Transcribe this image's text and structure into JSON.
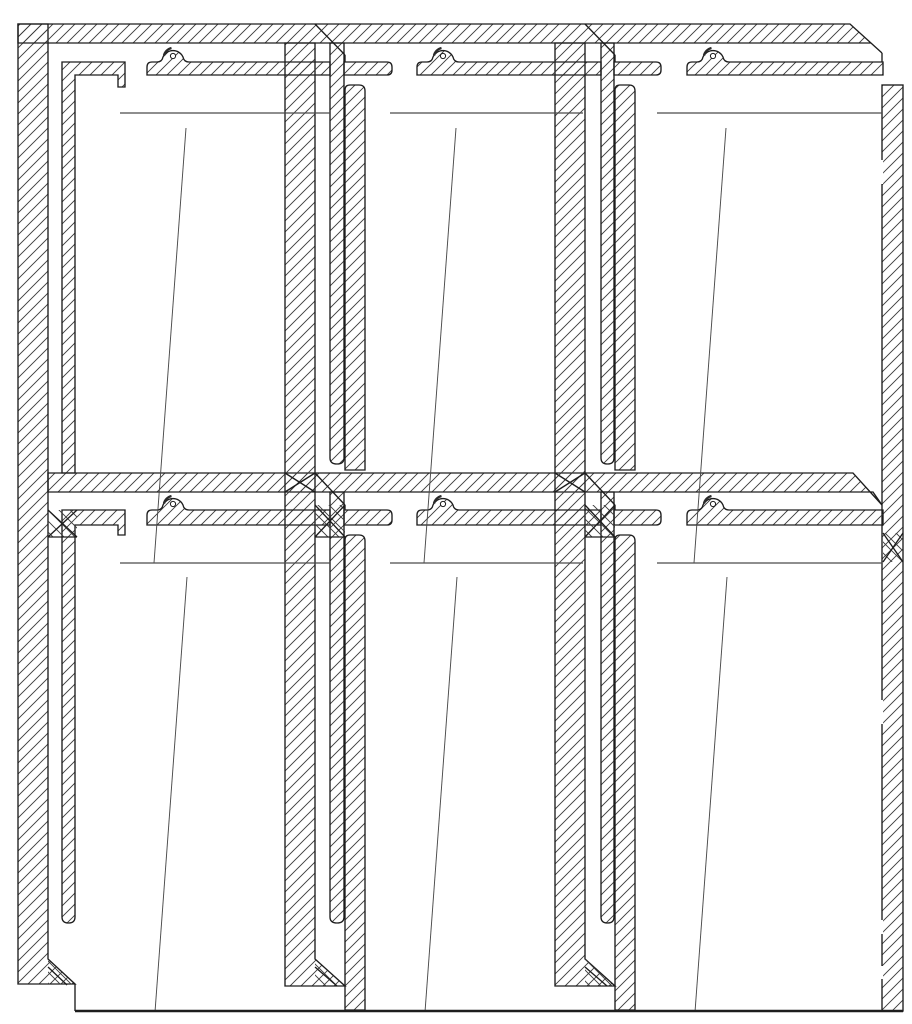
{
  "canvas": {
    "width": 912,
    "height": 1024,
    "background": "#ffffff"
  },
  "style": {
    "stroke": "#1d1d1d",
    "stroke_width": 1.35,
    "hatch_color": "#3c3c3c",
    "hatch_spacing": 11,
    "glass_line_color": "#4a4a4a",
    "boss_shadow_color": "#2a2a2a",
    "base_line_width": 2.4,
    "background": "#ffffff"
  },
  "drawing": {
    "kind": "cad-section-detail",
    "description": "Sectional detail of a six-panel glazed frame wall: 2 rows x 3 columns, hatched cut profiles, screw bosses, mitered joints",
    "rows": 2,
    "columns": 3,
    "screw_boss_count": 6
  },
  "shapes": [
    {
      "name": "left-jamb-profile",
      "t": "path",
      "d": "M18 24 H48 V959 L75 984 H18 Z"
    },
    {
      "name": "head-bar",
      "t": "path",
      "d": "M18 24 H850 L882 53 L871 43 H18 Z"
    },
    {
      "name": "mid-transom-bar",
      "t": "path",
      "d": "M48 473 H853 L882 505 L873 492 H48 Z"
    },
    {
      "name": "mullion-1-main-bar",
      "t": "path",
      "d": "M285 43 H315 V959 L345 986 H285 Z"
    },
    {
      "name": "mullion-2-main-bar",
      "t": "path",
      "d": "M555 43 H585 V959 L615 986 H555 Z"
    },
    {
      "name": "right-jamb-bar",
      "t": "rect",
      "x": 882,
      "y": 85,
      "w": 21,
      "h": 926
    },
    {
      "name": "glazing-L-profile-top-left",
      "t": "path",
      "d": "M62 62 H125 V87 H118 V75 H75 V473 H62 Z"
    },
    {
      "name": "glazing-L-profile-bottom-left",
      "t": "path",
      "d": "M62 510 H125 V535 H118 V525 H75 V917 Q75 923 68.5 923 Q62 923 62 917 Z"
    },
    {
      "name": "mullion-1-inner-profile-top",
      "t": "path",
      "d": "M330 43 H344 V458 Q344 464 337 464 Q330 464 330 458 Z"
    },
    {
      "name": "mullion-1-inner-profile-bottom",
      "t": "path",
      "d": "M330 492 H344 V917 Q344 923 337 923 Q330 923 330 917 Z"
    },
    {
      "name": "mullion-2-inner-profile-top",
      "t": "path",
      "d": "M601 43 H614 V458 Q614 464 607.5 464 Q601 464 601 458 Z"
    },
    {
      "name": "mullion-2-inner-profile-bottom",
      "t": "path",
      "d": "M601 492 H614 V917 Q614 923 607.5 923 Q601 923 601 917 Z"
    },
    {
      "name": "mullion-1-stop-profile-top",
      "t": "path",
      "d": "M345 470 V90 Q345 85 350 85 H359 Q365 85 365 91 V470 Z"
    },
    {
      "name": "mullion-1-stop-profile-bottom",
      "t": "path",
      "d": "M345 1010 V540 Q345 535 350 535 H359 Q365 535 365 541 V1010 Z"
    },
    {
      "name": "mullion-2-stop-profile-top",
      "t": "path",
      "d": "M615 470 V90 Q615 85 620 85 H629 Q635 85 635 91 V470 Z"
    },
    {
      "name": "mullion-2-stop-profile-bottom",
      "t": "path",
      "d": "M615 1010 V540 Q615 535 620 535 H629 Q635 535 635 541 V1010 Z"
    },
    {
      "name": "boss-strip-top-1",
      "t": "path",
      "d": "M147 75 V67 Q147 62 152 62 H157 Q162 62 163 57 A11 11 0 0 1 183 57 Q184 62 189 62 H330 V75 Z"
    },
    {
      "name": "boss-strip-top-2",
      "t": "path",
      "d": "M417 75 V67 Q417 62 422 62 H427 Q432 62 433 57 A11 11 0 0 1 453 57 Q454 62 459 62 H601 V75 Z"
    },
    {
      "name": "boss-strip-top-3",
      "t": "path",
      "d": "M687 75 V67 Q687 62 692 62 H697 Q702 62 703 57 A11 11 0 0 1 723 57 Q724 62 729 62 H883 V75 Z"
    },
    {
      "name": "stop-strip-top-a",
      "t": "path",
      "d": "M344 62 H387 Q392 62 392 67 V70 Q392 75 387 75 H344 Z"
    },
    {
      "name": "stop-strip-top-b",
      "t": "path",
      "d": "M614 62 H656 Q661 62 661 67 V70 Q661 75 656 75 H614 Z"
    },
    {
      "name": "boss-strip-mid-1",
      "t": "path",
      "d": "M147 525 V515 Q147 510 152 510 H157 Q162 510 163 505 A11 11 0 0 1 183 505 Q184 510 189 510 H330 V525 Z"
    },
    {
      "name": "boss-strip-mid-2",
      "t": "path",
      "d": "M417 525 V515 Q417 510 422 510 H427 Q432 510 433 505 A11 11 0 0 1 453 505 Q454 510 459 510 H601 V525 Z"
    },
    {
      "name": "boss-strip-mid-3",
      "t": "path",
      "d": "M687 525 V515 Q687 510 692 510 H697 Q702 510 703 505 A11 11 0 0 1 723 505 Q724 510 729 510 H883 V525 Z"
    },
    {
      "name": "stop-strip-mid-a",
      "t": "path",
      "d": "M344 510 H387 Q392 510 392 515 V520 Q392 525 387 525 H344 Z"
    },
    {
      "name": "stop-strip-mid-b",
      "t": "path",
      "d": "M614 510 H656 Q661 510 661 515 V520 Q661 525 656 525 H614 Z"
    },
    {
      "name": "miter-zone-left-mid",
      "t": "rect",
      "x": 48,
      "y": 510,
      "w": 29,
      "h": 27,
      "f": "hatchX",
      "sw": 0
    },
    {
      "name": "miter-zone-mullion-1-mid",
      "t": "rect",
      "x": 315,
      "y": 505,
      "w": 30,
      "h": 32,
      "f": "hatchX",
      "sw": 0
    },
    {
      "name": "miter-zone-mullion-2-mid",
      "t": "rect",
      "x": 585,
      "y": 505,
      "w": 30,
      "h": 32,
      "f": "hatchX",
      "sw": 0
    },
    {
      "name": "miter-zone-right-mid",
      "t": "rect",
      "x": 883,
      "y": 533,
      "w": 20,
      "h": 29,
      "f": "hatchX",
      "sw": 0
    },
    {
      "name": "chamfer-fill-left-bottom",
      "t": "path",
      "d": "M48 959 L75 984 H48 Z",
      "f": "hatchX",
      "sw": 0
    },
    {
      "name": "chamfer-fill-mullion-1-bottom",
      "t": "path",
      "d": "M315 959 L345 986 H315 Z",
      "f": "hatchX",
      "sw": 0
    },
    {
      "name": "chamfer-fill-mullion-2-bottom",
      "t": "path",
      "d": "M585 959 L615 986 H585 Z",
      "f": "hatchX",
      "sw": 0
    },
    {
      "name": "screw-boss-circle",
      "t": "circle",
      "cx": 173,
      "cy": 56,
      "r": 2.6,
      "f": "white",
      "sw": 1
    },
    {
      "name": "screw-boss-circle",
      "t": "circle",
      "cx": 443,
      "cy": 56,
      "r": 2.6,
      "f": "white",
      "sw": 1
    },
    {
      "name": "screw-boss-circle",
      "t": "circle",
      "cx": 713,
      "cy": 56,
      "r": 2.6,
      "f": "white",
      "sw": 1
    },
    {
      "name": "screw-boss-circle",
      "t": "circle",
      "cx": 173,
      "cy": 504,
      "r": 2.6,
      "f": "white",
      "sw": 1
    },
    {
      "name": "screw-boss-circle",
      "t": "circle",
      "cx": 443,
      "cy": 504,
      "r": 2.6,
      "f": "white",
      "sw": 1
    },
    {
      "name": "screw-boss-circle",
      "t": "circle",
      "cx": 713,
      "cy": 504,
      "r": 2.6,
      "f": "white",
      "sw": 1
    },
    {
      "name": "boss-shadow-arc",
      "t": "path",
      "d": "M164 55.5 A10 10 0 0 1 171.5 48",
      "f": "none",
      "sw": 2.4,
      "sc": "shadow"
    },
    {
      "name": "boss-shadow-arc",
      "t": "path",
      "d": "M434 55.5 A10 10 0 0 1 441.5 48",
      "f": "none",
      "sw": 2.4,
      "sc": "shadow"
    },
    {
      "name": "boss-shadow-arc",
      "t": "path",
      "d": "M704 55.5 A10 10 0 0 1 711.5 48",
      "f": "none",
      "sw": 2.4,
      "sc": "shadow"
    },
    {
      "name": "boss-shadow-arc",
      "t": "path",
      "d": "M164 503.5 A10 10 0 0 1 171.5 496",
      "f": "none",
      "sw": 2.4,
      "sc": "shadow"
    },
    {
      "name": "boss-shadow-arc",
      "t": "path",
      "d": "M434 503.5 A10 10 0 0 1 441.5 496",
      "f": "none",
      "sw": 2.4,
      "sc": "shadow"
    },
    {
      "name": "boss-shadow-arc",
      "t": "path",
      "d": "M704 503.5 A10 10 0 0 1 711.5 496",
      "f": "none",
      "sw": 2.4,
      "sc": "shadow"
    },
    {
      "name": "head-seam-mullion-1",
      "t": "line",
      "x1": 315,
      "y1": 24,
      "x2": 345,
      "y2": 55
    },
    {
      "name": "head-seam-mullion-1-drop",
      "t": "line",
      "x1": 345,
      "y1": 55,
      "x2": 345,
      "y2": 62
    },
    {
      "name": "head-seam-mullion-2",
      "t": "line",
      "x1": 585,
      "y1": 24,
      "x2": 615,
      "y2": 55
    },
    {
      "name": "head-seam-mullion-2-drop",
      "t": "line",
      "x1": 615,
      "y1": 55,
      "x2": 615,
      "y2": 62
    },
    {
      "name": "head-tip-drop-right",
      "t": "line",
      "x1": 882,
      "y1": 53,
      "x2": 882,
      "y2": 62
    },
    {
      "name": "transom-seam-mullion-1",
      "t": "line",
      "x1": 315,
      "y1": 473,
      "x2": 345,
      "y2": 505
    },
    {
      "name": "transom-seam-mullion-1-drop",
      "t": "line",
      "x1": 345,
      "y1": 505,
      "x2": 345,
      "y2": 510
    },
    {
      "name": "transom-seam-mullion-2",
      "t": "line",
      "x1": 585,
      "y1": 473,
      "x2": 615,
      "y2": 505
    },
    {
      "name": "transom-seam-mullion-2-drop",
      "t": "line",
      "x1": 615,
      "y1": 505,
      "x2": 615,
      "y2": 510
    },
    {
      "name": "miter-cross-line",
      "t": "line",
      "x1": 48,
      "y1": 510,
      "x2": 77,
      "y2": 537
    },
    {
      "name": "miter-cross-line",
      "t": "line",
      "x1": 77,
      "y1": 510,
      "x2": 48,
      "y2": 537
    },
    {
      "name": "miter-bottom-edge",
      "t": "line",
      "x1": 48,
      "y1": 537,
      "x2": 77,
      "y2": 537
    },
    {
      "name": "miter-cross-line",
      "t": "line",
      "x1": 285,
      "y1": 473,
      "x2": 315,
      "y2": 492
    },
    {
      "name": "miter-cross-line",
      "t": "line",
      "x1": 315,
      "y1": 473,
      "x2": 285,
      "y2": 492
    },
    {
      "name": "miter-cross-line",
      "t": "line",
      "x1": 315,
      "y1": 505,
      "x2": 345,
      "y2": 537
    },
    {
      "name": "miter-cross-line",
      "t": "line",
      "x1": 345,
      "y1": 505,
      "x2": 315,
      "y2": 537
    },
    {
      "name": "miter-bottom-edge",
      "t": "line",
      "x1": 315,
      "y1": 537,
      "x2": 345,
      "y2": 537
    },
    {
      "name": "miter-cross-line",
      "t": "line",
      "x1": 555,
      "y1": 473,
      "x2": 585,
      "y2": 492
    },
    {
      "name": "miter-cross-line",
      "t": "line",
      "x1": 585,
      "y1": 473,
      "x2": 555,
      "y2": 492
    },
    {
      "name": "miter-cross-line",
      "t": "line",
      "x1": 585,
      "y1": 505,
      "x2": 615,
      "y2": 537
    },
    {
      "name": "miter-cross-line",
      "t": "line",
      "x1": 615,
      "y1": 505,
      "x2": 585,
      "y2": 537
    },
    {
      "name": "miter-bottom-edge",
      "t": "line",
      "x1": 585,
      "y1": 537,
      "x2": 615,
      "y2": 537
    },
    {
      "name": "miter-cross-line",
      "t": "line",
      "x1": 883,
      "y1": 533,
      "x2": 903,
      "y2": 562
    },
    {
      "name": "miter-cross-line",
      "t": "line",
      "x1": 903,
      "y1": 533,
      "x2": 883,
      "y2": 562
    },
    {
      "name": "chamfer-seam-left-bottom",
      "t": "line",
      "x1": 48,
      "y1": 967,
      "x2": 67,
      "y2": 985
    },
    {
      "name": "chamfer-seam-mullion-1-bottom",
      "t": "line",
      "x1": 315,
      "y1": 967,
      "x2": 337,
      "y2": 986
    },
    {
      "name": "chamfer-seam-mullion-2-bottom",
      "t": "line",
      "x1": 585,
      "y1": 967,
      "x2": 607,
      "y2": 986
    },
    {
      "name": "left-base-step",
      "t": "line",
      "x1": 75,
      "y1": 984,
      "x2": 75,
      "y2": 1011
    },
    {
      "name": "hidden-edge-gap",
      "t": "line",
      "x1": 882,
      "y1": 160,
      "x2": 882,
      "y2": 184,
      "sc": "white",
      "sw": 2.2
    },
    {
      "name": "hidden-edge-gap",
      "t": "line",
      "x1": 882,
      "y1": 700,
      "x2": 882,
      "y2": 724,
      "sc": "white",
      "sw": 2.2
    },
    {
      "name": "hidden-edge-gap",
      "t": "line",
      "x1": 882,
      "y1": 920,
      "x2": 882,
      "y2": 934,
      "sc": "white",
      "sw": 2.2
    },
    {
      "name": "hidden-edge-gap",
      "t": "line",
      "x1": 882,
      "y1": 966,
      "x2": 882,
      "y2": 979,
      "sc": "white",
      "sw": 2.2
    },
    {
      "name": "glass-edge-line",
      "t": "line",
      "x1": 120,
      "y1": 113,
      "x2": 330,
      "y2": 113,
      "sc": "glass",
      "sw": 1.15
    },
    {
      "name": "glass-edge-line",
      "t": "line",
      "x1": 390,
      "y1": 113,
      "x2": 583,
      "y2": 113,
      "sc": "glass",
      "sw": 1.15
    },
    {
      "name": "glass-edge-line",
      "t": "line",
      "x1": 657,
      "y1": 113,
      "x2": 882,
      "y2": 113,
      "sc": "glass",
      "sw": 1.15
    },
    {
      "name": "glass-edge-line",
      "t": "line",
      "x1": 120,
      "y1": 563,
      "x2": 330,
      "y2": 563,
      "sc": "glass",
      "sw": 1.15
    },
    {
      "name": "glass-edge-line",
      "t": "line",
      "x1": 390,
      "y1": 563,
      "x2": 583,
      "y2": 563,
      "sc": "glass",
      "sw": 1.15
    },
    {
      "name": "glass-edge-line",
      "t": "line",
      "x1": 657,
      "y1": 563,
      "x2": 882,
      "y2": 563,
      "sc": "glass",
      "sw": 1.15
    },
    {
      "name": "glass-pane-mark",
      "t": "line",
      "x1": 186,
      "y1": 128,
      "x2": 154,
      "y2": 563,
      "sc": "glass",
      "sw": 0.95
    },
    {
      "name": "glass-pane-mark",
      "t": "line",
      "x1": 456,
      "y1": 128,
      "x2": 424,
      "y2": 563,
      "sc": "glass",
      "sw": 0.95
    },
    {
      "name": "glass-pane-mark",
      "t": "line",
      "x1": 726,
      "y1": 128,
      "x2": 694,
      "y2": 563,
      "sc": "glass",
      "sw": 0.95
    },
    {
      "name": "glass-pane-mark",
      "t": "line",
      "x1": 187,
      "y1": 577,
      "x2": 155,
      "y2": 1012,
      "sc": "glass",
      "sw": 0.95
    },
    {
      "name": "glass-pane-mark",
      "t": "line",
      "x1": 457,
      "y1": 577,
      "x2": 425,
      "y2": 1012,
      "sc": "glass",
      "sw": 0.95
    },
    {
      "name": "glass-pane-mark",
      "t": "line",
      "x1": 727,
      "y1": 577,
      "x2": 695,
      "y2": 1012,
      "sc": "glass",
      "sw": 0.95
    },
    {
      "name": "base-line",
      "t": "line",
      "x1": 75,
      "y1": 1011,
      "x2": 903,
      "y2": 1011,
      "sw": 2.4
    }
  ]
}
